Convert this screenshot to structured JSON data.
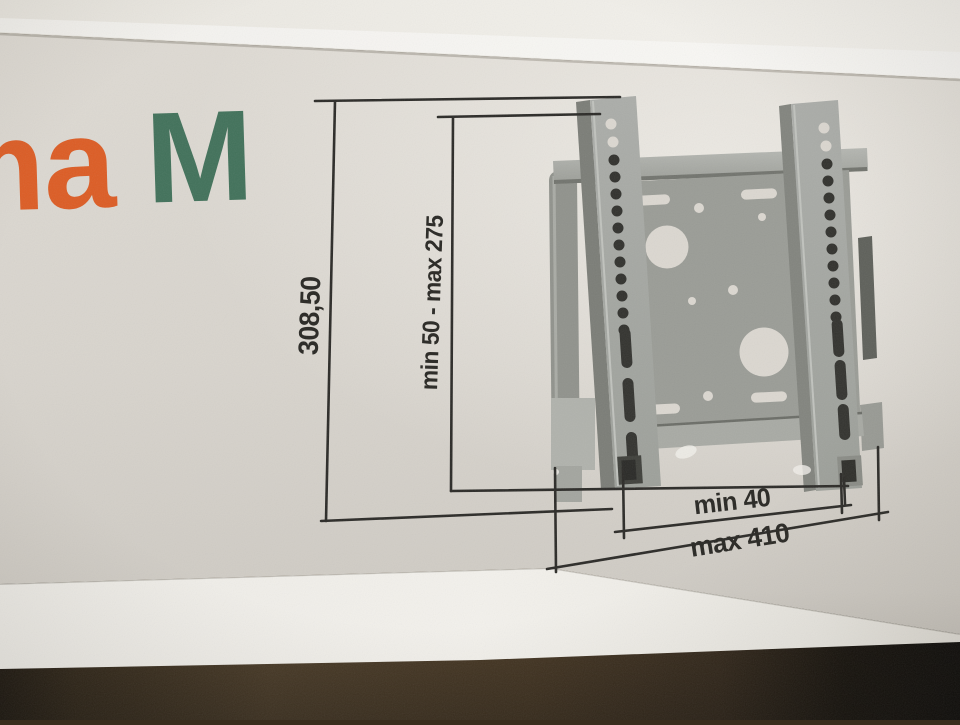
{
  "scene": {
    "description": "Photograph of product packaging lying on a dark wooden floor, showing a dimensioned technical drawing of a flat TV wall-mount bracket",
    "floor_color": "#54422a",
    "panel_color": "#d9d5ce"
  },
  "brand": {
    "fragment_orange": "ma",
    "fragment_green": "M",
    "orange": "#dc5c24",
    "green": "#41715a"
  },
  "diagram": {
    "line_color": "#2b2a27",
    "label_color": "#282723",
    "labels": {
      "height_total": "308,50",
      "height_range": "min 50 - max 275",
      "width_min": "min 40",
      "width_max": "max 410"
    }
  }
}
